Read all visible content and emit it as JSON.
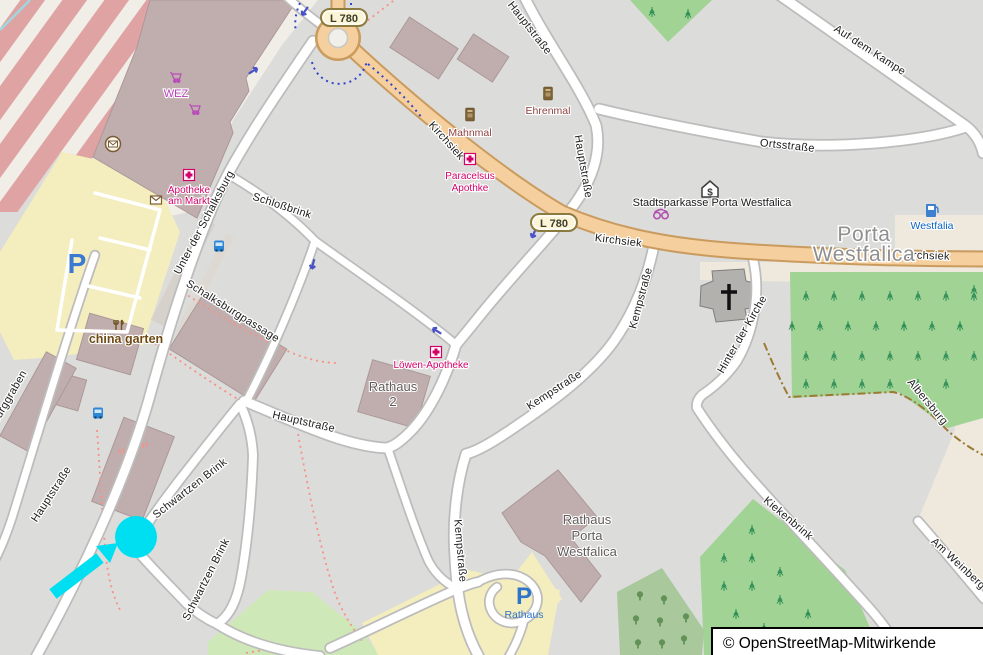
{
  "attribution": "© OpenStreetMap-Mitwirkende",
  "badge": "L 780",
  "city": {
    "line1": "Porta",
    "line2": "Westfalica"
  },
  "streets": {
    "hauptstrasse": "Hauptstraße",
    "kirchsiek": "Kirchsiek",
    "ortsstrasse": "Ortsstraße",
    "auf_dem_kampe": "Auf dem Kampe",
    "unter_der_schalksburg": "Unter der Schalksburg",
    "schlossbrink": "Schloßbrink",
    "schalksburgpassage": "Schalksburgpassage",
    "kempstrasse": "Kempstraße",
    "hinter_der_kirche": "Hinter der Kirche",
    "kiekenbrink": "Kiekenbrink",
    "am_weinberg": "Am Weinberg",
    "albersburg": "Albersburg",
    "schwartzen_brink": "Schwartzen Brink",
    "burggraben": "Burggraben"
  },
  "pois": {
    "wez": "WEZ",
    "apotheke_markt_1": "Apotheke",
    "apotheke_markt_2": "am Markt",
    "mahnmal": "Mahnmal",
    "ehrenmal": "Ehrenmal",
    "paracelsus_1": "Paracelsus",
    "paracelsus_2": "Apothke",
    "stadtsparkasse": "Stadtsparkasse Porta Westfalica",
    "westfalia": "Westfalia",
    "china_garten": "china garten",
    "loewen_apotheke": "Löwen-Apotheke",
    "rathaus2_1": "Rathaus",
    "rathaus2_2": "2",
    "rathaus_pw_1": "Rathaus",
    "rathaus_pw_2": "Porta",
    "rathaus_pw_3": "Westfalica"
  },
  "parking": {
    "symbol": "P",
    "rathaus": "Rathaus"
  },
  "colors": {
    "marker": "#00dff2",
    "road_primary": "#f5cf9d",
    "forest": "#a1d394",
    "grass": "#cfe8b7",
    "railway_band": "#dfa3a3",
    "building": "#c0aeae"
  }
}
